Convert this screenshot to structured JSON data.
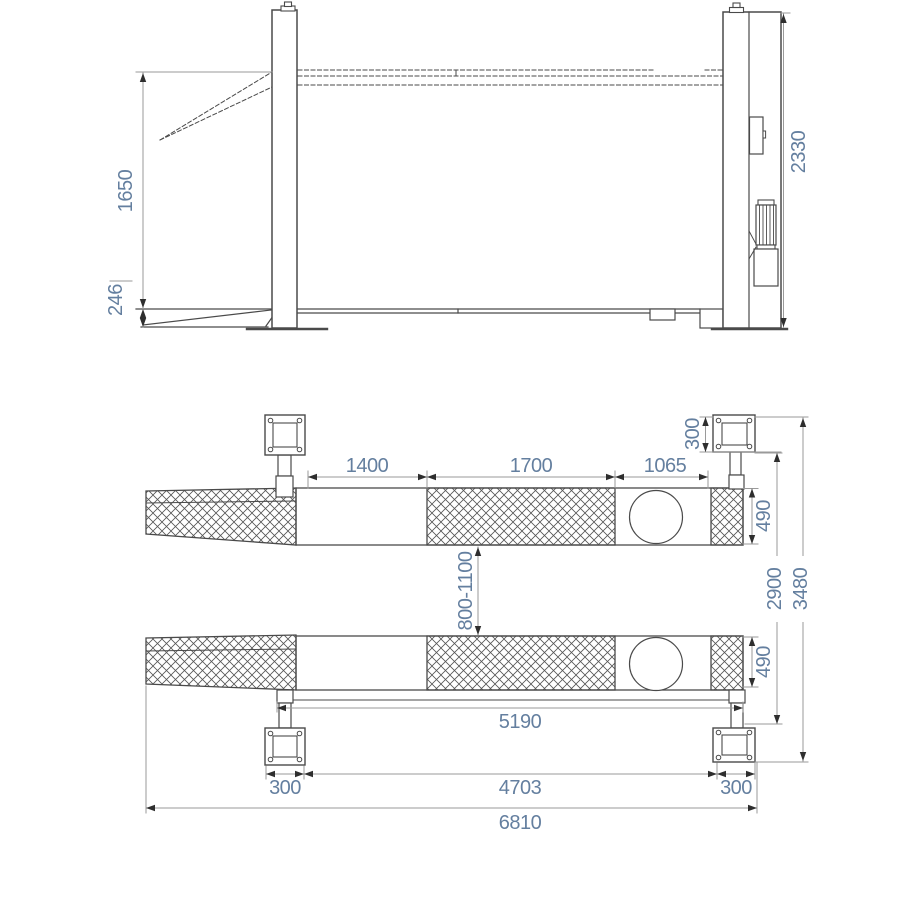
{
  "side_view": {
    "dim_lift_height": "1650",
    "dim_min_height": "246",
    "dim_column_height": "2330"
  },
  "plan_view": {
    "dim_section_front": "1400",
    "dim_section_mid": "1700",
    "dim_section_turnplate": "1065",
    "dim_base_plate_top": "300",
    "dim_runway_width_top": "490",
    "dim_runway_gap": "800-1100",
    "dim_runway_width_bottom": "490",
    "dim_width_inner": "2900",
    "dim_width_overall": "3480",
    "dim_post_span": "5190",
    "dim_base_plate_left": "300",
    "dim_length_inner": "4703",
    "dim_base_plate_right": "300",
    "dim_length_overall": "6810"
  },
  "colors": {
    "dimension_text": "#647f9f",
    "drawing_line": "#4a4a4a",
    "dimension_line": "#9a9a9a"
  }
}
